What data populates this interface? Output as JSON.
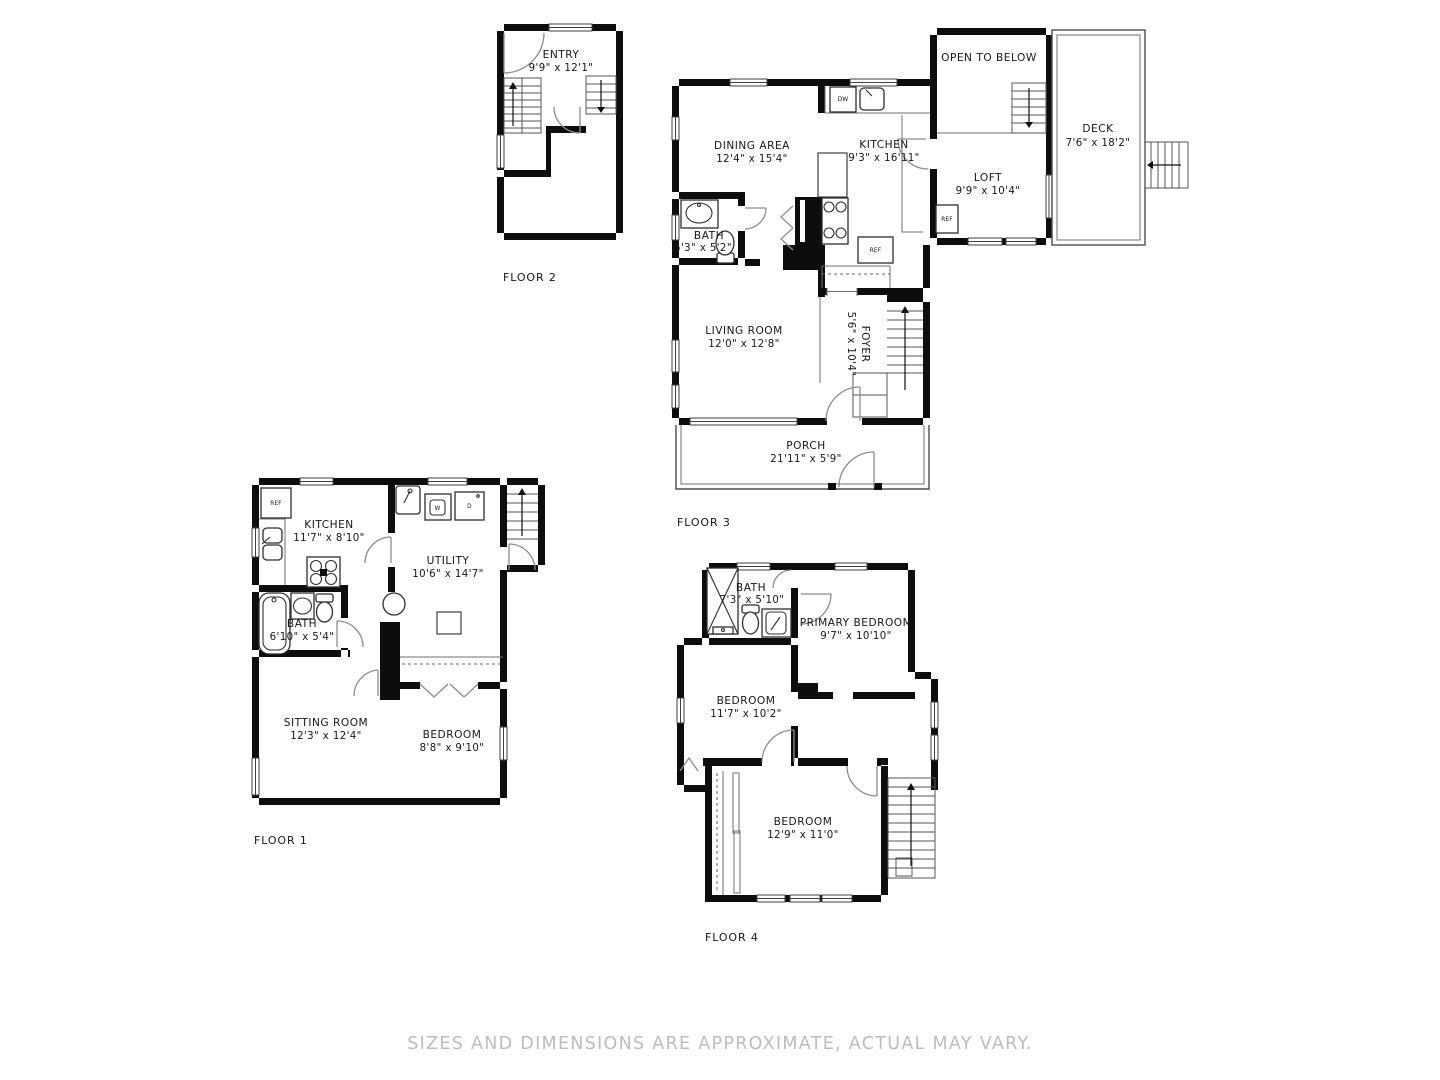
{
  "disclaimer": "SIZES AND DIMENSIONS ARE APPROXIMATE, ACTUAL MAY VARY.",
  "floor1": {
    "label": "FLOOR 1",
    "kitchen": {
      "name": "KITCHEN",
      "dims": "11'7\" x 8'10\""
    },
    "utility": {
      "name": "UTILITY",
      "dims": "10'6\" x 14'7\""
    },
    "bath": {
      "name": "BATH",
      "dims": "6'10\" x 5'4\""
    },
    "sitting": {
      "name": "SITTING ROOM",
      "dims": "12'3\" x 12'4\""
    },
    "bedroom": {
      "name": "BEDROOM",
      "dims": "8'8\" x 9'10\""
    },
    "ref": "REF",
    "washer": "W",
    "dryer": "D"
  },
  "floor2": {
    "label": "FLOOR 2",
    "entry": {
      "name": "ENTRY",
      "dims": "9'9\" x 12'1\""
    }
  },
  "floor3": {
    "label": "FLOOR 3",
    "dining": {
      "name": "DINING AREA",
      "dims": "12'4\" x 15'4\""
    },
    "kitchen": {
      "name": "KITCHEN",
      "dims": "9'3\" x 16'11\""
    },
    "bath": {
      "name": "BATH",
      "dims": "5'3\" x 5'2\""
    },
    "living": {
      "name": "LIVING ROOM",
      "dims": "12'0\" x 12'8\""
    },
    "foyer": {
      "name": "FOYER",
      "dims": "5'6\" x 10'4\""
    },
    "porch": {
      "name": "PORCH",
      "dims": "21'11\" x 5'9\""
    },
    "loft": {
      "name": "LOFT",
      "dims": "9'9\" x 10'4\""
    },
    "deck": {
      "name": "DECK",
      "dims": "7'6\" x 18'2\""
    },
    "open_below": "OPEN TO BELOW",
    "dw": "DW",
    "ref": "REF"
  },
  "floor4": {
    "label": "FLOOR 4",
    "bath": {
      "name": "BATH",
      "dims": "7'3\" x 5'10\""
    },
    "primary": {
      "name": "PRIMARY BEDROOM",
      "dims": "9'7\" x 10'10\""
    },
    "bedroom_a": {
      "name": "BEDROOM",
      "dims": "11'7\" x 10'2\""
    },
    "bedroom_b": {
      "name": "BEDROOM",
      "dims": "12'9\" x 11'0\""
    }
  }
}
